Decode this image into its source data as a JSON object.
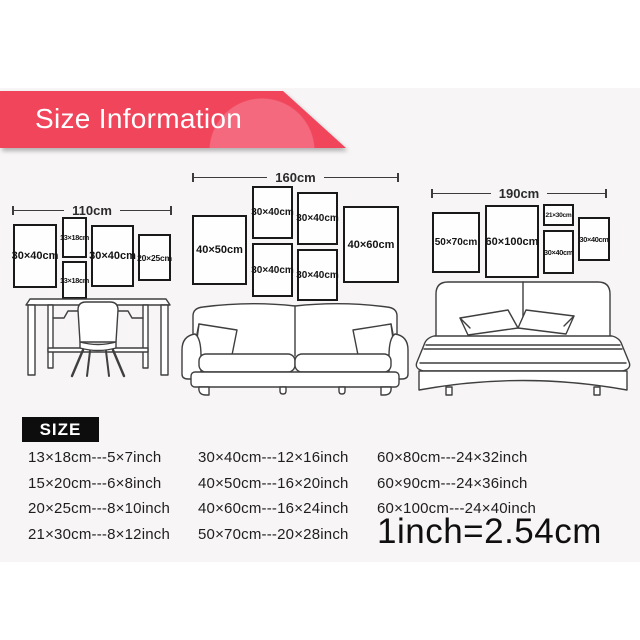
{
  "banner": {
    "title": "Size Information",
    "bg_color": "#f1455c",
    "highlight_color": "#f4697d",
    "text_color": "#ffffff"
  },
  "groups": [
    {
      "width_label": "110cm",
      "frames": [
        "30×40cm",
        "13×18cm",
        "13×18cm",
        "30×40cm",
        "20×25cm"
      ]
    },
    {
      "width_label": "160cm",
      "frames": [
        "40×50cm",
        "30×40cm",
        "30×40cm",
        "30×40cm",
        "30×40cm",
        "40×60cm"
      ]
    },
    {
      "width_label": "190cm",
      "frames": [
        "50×70cm",
        "60×100cm",
        "21×30cm",
        "30×40cm",
        "30×40cm"
      ]
    }
  ],
  "illustrations": [
    "desk-and-chair",
    "sofa",
    "bed"
  ],
  "size_section": {
    "heading": "SIZE",
    "columns": [
      {
        "rows": [
          "13×18cm---5×7inch",
          "15×20cm---6×8inch",
          "20×25cm---8×10inch",
          "21×30cm---8×12inch"
        ]
      },
      {
        "rows": [
          "30×40cm---12×16inch",
          "40×50cm---16×20inch",
          "40×60cm---16×24inch",
          "50×70cm---20×28inch"
        ]
      },
      {
        "rows": [
          "60×80cm---24×32inch",
          "60×90cm---24×36inch",
          "60×100cm---24×40inch"
        ]
      }
    ],
    "note": "1inch=2.54cm"
  }
}
